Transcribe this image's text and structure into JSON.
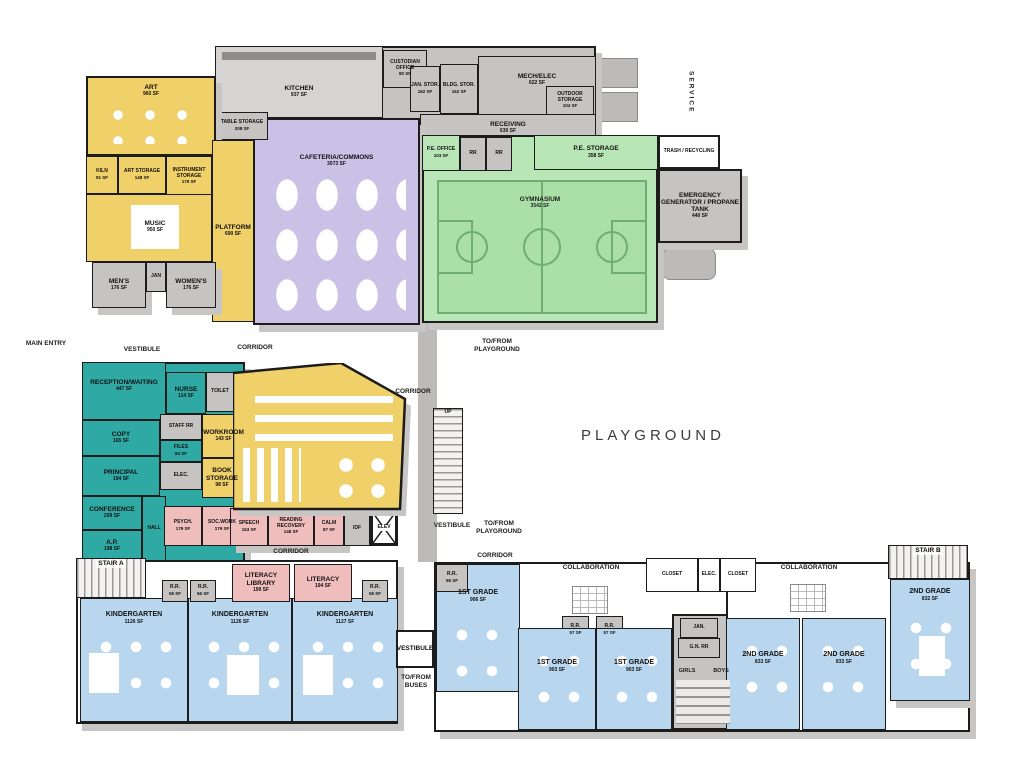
{
  "title": "Elementary School First Floor Plan",
  "palette": {
    "music_art_wing": "#f0d069",
    "cafeteria": "#c9c1e6",
    "gym": "#b9e6b6",
    "service": "#c6c4c2",
    "admin": "#2fa9a4",
    "support": "#f0bdbd",
    "classrooms": "#b9d6ef",
    "walls": "#1c1c1c",
    "shadow": "#c8c6c4"
  },
  "site": {
    "playground": "PLAYGROUND",
    "main_entry": "MAIN ENTRY",
    "vestibule": "VESTIBULE",
    "corridor": "CORRIDOR",
    "to_from_playground": "TO/FROM PLAYGROUND",
    "to_from_buses": "TO/FROM BUSES",
    "service": "SERVICE",
    "collaboration": "COLLABORATION",
    "up": "UP"
  },
  "rooms": {
    "art": {
      "label": "ART",
      "sf": "960 SF"
    },
    "kiln": {
      "label": "KILN",
      "sf": "91 SF"
    },
    "art_storage": {
      "label": "ART STORAGE",
      "sf": "148 SF"
    },
    "instrument_storage": {
      "label": "INSTRUMENT STORAGE",
      "sf": "179 SF"
    },
    "music": {
      "label": "MUSIC",
      "sf": "950 SF"
    },
    "platform": {
      "label": "PLATFORM",
      "sf": "690 SF"
    },
    "table_storage": {
      "label": "TABLE STORAGE",
      "sf": "208 SF"
    },
    "mens": {
      "label": "MEN'S",
      "sf": "176 SF"
    },
    "jan_top": {
      "label": "JAN"
    },
    "womens": {
      "label": "WOMEN'S",
      "sf": "176 SF"
    },
    "kitchen": {
      "label": "KITCHEN",
      "sf": "937 SF"
    },
    "custodian_office": {
      "label": "CUSTODIAN OFFICE",
      "sf": "80 SF"
    },
    "jan_stor": {
      "label": "JAN. STOR.",
      "sf": "162 SF"
    },
    "bldg_stor": {
      "label": "BLDG. STOR.",
      "sf": "162 SF"
    },
    "mech_elec": {
      "label": "MECH/ELEC",
      "sf": "622 SF"
    },
    "outdoor_storage": {
      "label": "OUTDOOR STORAGE",
      "sf": "104 SF"
    },
    "receiving": {
      "label": "RECEIVING",
      "sf": "630 SF"
    },
    "cafeteria": {
      "label": "CAFETERIA/COMMONS",
      "sf": "3073 SF"
    },
    "pe_office": {
      "label": "P.E. OFFICE",
      "sf": "103 SF"
    },
    "pe_rr": {
      "label": "RR"
    },
    "pe_storage": {
      "label": "P.E. STORAGE",
      "sf": "358 SF"
    },
    "gymnasium": {
      "label": "GYMNASIUM",
      "sf": "3542 SF"
    },
    "trash": {
      "label": "TRASH / RECYCLING"
    },
    "emergency": {
      "label": "EMERGENCY GENERATOR / PROPANE TANK",
      "sf": "440 SF"
    },
    "reception": {
      "label": "RECEPTION/WAITING",
      "sf": "447 SF"
    },
    "nurse": {
      "label": "NURSE",
      "sf": "114 SF"
    },
    "toilet": {
      "label": "TOILET"
    },
    "staff_rr": {
      "label": "STAFF RR"
    },
    "copy": {
      "label": "COPY",
      "sf": "165 SF"
    },
    "files": {
      "label": "FILES",
      "sf": "84 SF"
    },
    "workroom": {
      "label": "WORKROOM",
      "sf": "143 SF"
    },
    "elec": {
      "label": "ELEC."
    },
    "book_storage": {
      "label": "BOOK STORAGE",
      "sf": "98 SF"
    },
    "principal": {
      "label": "PRINCIPAL",
      "sf": "194 SF"
    },
    "conference": {
      "label": "CONFERENCE",
      "sf": "209 SF"
    },
    "hall": {
      "label": "HALL"
    },
    "ap": {
      "label": "A.P.",
      "sf": "198 SF"
    },
    "psych": {
      "label": "PSYCH.",
      "sf": "179 SF"
    },
    "socwork": {
      "label": "SOC.WORK",
      "sf": "179 SF"
    },
    "speech": {
      "label": "SPEECH",
      "sf": "153 SF"
    },
    "reading_recovery": {
      "label": "READING RECOVERY",
      "sf": "148 SF"
    },
    "calm": {
      "label": "CALM",
      "sf": "87 SF"
    },
    "idf": {
      "label": "IDF"
    },
    "elev": {
      "label": "ELEV"
    },
    "stair_a": {
      "label": "STAIR A"
    },
    "stair_b": {
      "label": "STAIR B"
    },
    "rr_56": {
      "label": "R.R.",
      "sf": "56 SF"
    },
    "rr_57": {
      "label": "R.R.",
      "sf": "57 SF"
    },
    "kindergarten1": {
      "label": "KINDERGARTEN",
      "sf": "1126 SF"
    },
    "kindergarten2": {
      "label": "KINDERGARTEN",
      "sf": "1126 SF"
    },
    "kindergarten3": {
      "label": "KINDERGARTEN",
      "sf": "1127 SF"
    },
    "literacy_library": {
      "label": "LITERACY LIBRARY",
      "sf": "199 SF"
    },
    "literacy": {
      "label": "LITERACY",
      "sf": "194 SF"
    },
    "first_grade_1": {
      "label": "1ST GRADE",
      "sf": "906 SF"
    },
    "first_grade_2": {
      "label": "1ST GRADE",
      "sf": "903 SF"
    },
    "first_grade_3": {
      "label": "1ST GRADE",
      "sf": "903 SF"
    },
    "second_grade_1": {
      "label": "2ND GRADE",
      "sf": "833 SF"
    },
    "second_grade_2": {
      "label": "2ND GRADE",
      "sf": "833 SF"
    },
    "second_grade_3": {
      "label": "2ND GRADE",
      "sf": "832 SF"
    },
    "jan_bottom": {
      "label": "JAN."
    },
    "gn_rr": {
      "label": "G.N. RR"
    },
    "girls": {
      "label": "GIRLS"
    },
    "boys": {
      "label": "BOYS"
    },
    "closet": {
      "label": "CLOSET"
    },
    "elec_closet": {
      "label": "ELEC."
    }
  }
}
